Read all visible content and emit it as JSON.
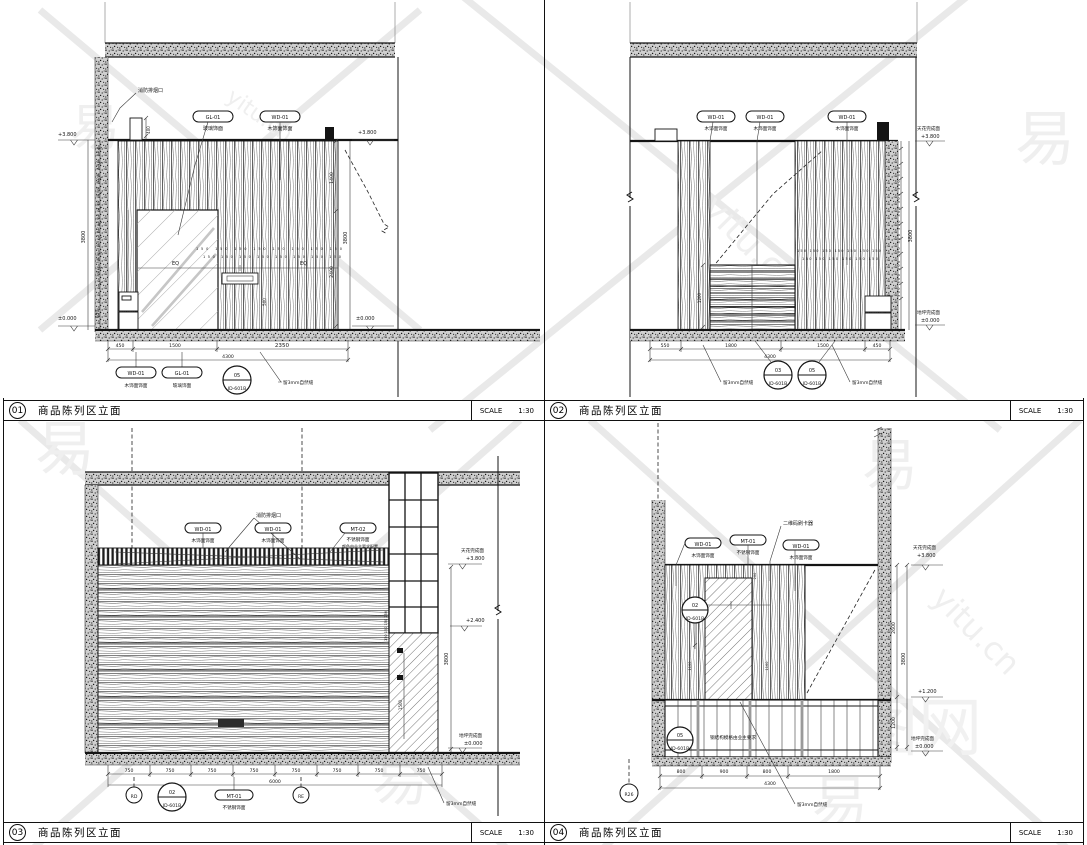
{
  "titlebar": {
    "title": "商品陈列区立面",
    "scale_label": "SCALE",
    "scale_value": "1:30",
    "numbers": [
      "01",
      "02",
      "03",
      "04"
    ]
  },
  "p1": {
    "vent": "消防排烟口",
    "gl": "GL-01",
    "gl_desc": "玻璃饰面",
    "wd": "WD-01",
    "wd_desc": "木饰面饰面",
    "lv_top": "+3.800",
    "lv_floor": "±0.000",
    "d_3800": "3800",
    "d_650": "650",
    "d_400": "400",
    "d_ticks300": "300 300 300 300 300 300 300 300 300 300",
    "d_1400": "1400",
    "d_2400": "2400",
    "row150a": "150 150 150 150 150 150 150 150",
    "row150b": "150 150 150 150 150 150 150 150",
    "eq": "EQ",
    "d_500": "500",
    "dims": [
      "450",
      "1500",
      "2350"
    ],
    "d_total": "4300",
    "bub_n": "05",
    "bub_id": "ID-601B",
    "seam": "留3mm自然缝"
  },
  "p2": {
    "wd": "WD-01",
    "wd_desc": "木饰面饰面",
    "ceil_label": "天花完成面",
    "lv_top": "+3.800",
    "floor_label": "地坪完成面",
    "lv_floor": "±0.000",
    "d_3800": "3800",
    "d_ticks300": "300 300 300 300 300 300 300 300 300 300",
    "row150a": "150 150 150 150 150 150 150",
    "row150b": "150 150 150 150 150 150",
    "d_1200": "1200",
    "dims": [
      "550",
      "1800",
      "1500",
      "450"
    ],
    "d_total": "4300",
    "bub1_n": "03",
    "bub2_n": "05",
    "bub_id": "ID-601B",
    "seam": "留3mm自然缝"
  },
  "p3": {
    "wd": "WD-01",
    "wd_desc": "木饰面饰面",
    "vent": "消防排烟口",
    "mt2": "MT-02",
    "mt2_d1": "不锈钢饰面",
    "mt2_d2": "颜色由业主要求配置",
    "mt1": "MT-01",
    "mt1_desc": "不锈钢饰面",
    "ceil_label": "天花完成面",
    "lv_top": "+3.800",
    "lv_mid": "+2.400",
    "floor_label": "地坪完成面",
    "lv_floor": "±0.000",
    "d_3800": "3800",
    "d_1500": "1500",
    "row150": "150 150 150 150",
    "dims": [
      "750",
      "750",
      "750",
      "750",
      "750",
      "750",
      "750",
      "750"
    ],
    "d_total": "6000",
    "gb_l": "RD",
    "gb_r": "RE",
    "bub_n": "02",
    "bub_id": "ID-601B",
    "seam": "留3mm自然缝"
  },
  "p4": {
    "wd": "WD-01",
    "wd_desc": "木饰面饰面",
    "mt1": "MT-01",
    "mt1_desc": "不锈钢饰面",
    "qr": "二维码刷卡器",
    "steel": "钢结构模格由业主要求",
    "ceil_label": "天花完成面",
    "lv_top": "+3.800",
    "lv_mid": "+1.200",
    "floor_label": "地坪完成面",
    "lv_floor": "±0.000",
    "d_2600": "2600",
    "d_3800": "3800",
    "d_1200": "1200",
    "d_200": "200",
    "d_1160a": "1160",
    "d_1160b": "1160",
    "dims": [
      "800",
      "900",
      "800",
      "1800"
    ],
    "d_total": "4300",
    "gb": "R26",
    "bub1_n": "02",
    "bub2_n": "05",
    "bub_id": "ID-601B",
    "seam": "留3mm自然缝"
  },
  "watermark": {
    "char": "易",
    "site": "yitu.cn",
    "brand": "易图网"
  }
}
